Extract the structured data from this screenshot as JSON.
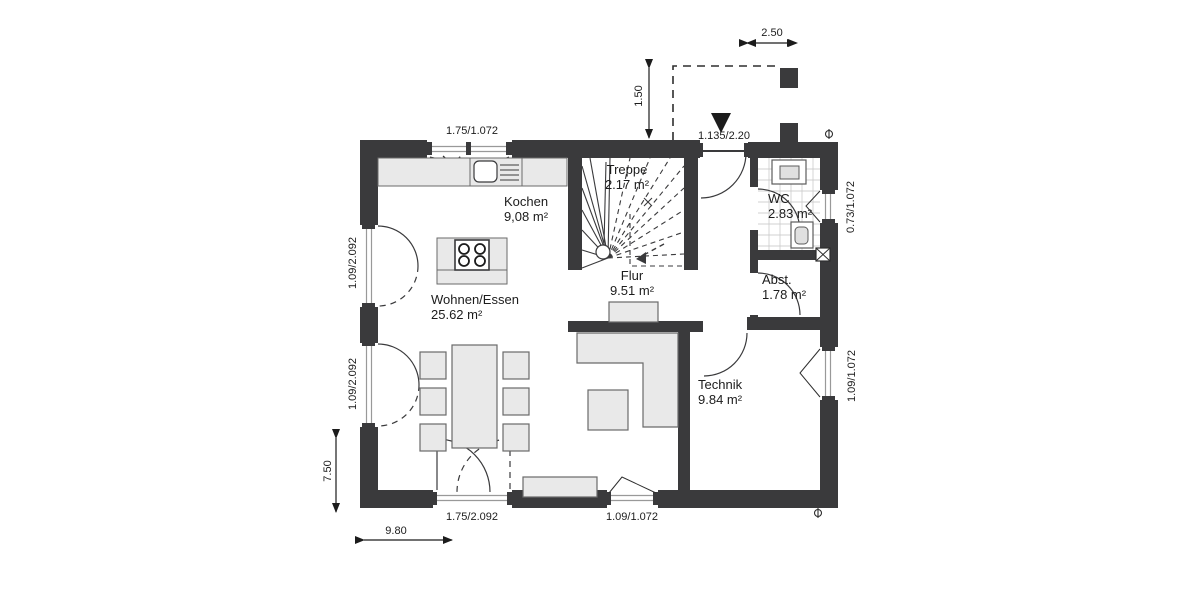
{
  "plan": {
    "type": "floor-plan",
    "rooms": {
      "treppe": {
        "name": "Treppe",
        "area": "2.17 m²"
      },
      "kochen": {
        "name": "Kochen",
        "area": "9,08 m²"
      },
      "flur": {
        "name": "Flur",
        "area": "9.51 m²"
      },
      "wc": {
        "name": "WC",
        "area": "2.83 m²"
      },
      "abst": {
        "name": "Abst.",
        "area": "1.78 m²"
      },
      "technik": {
        "name": "Technik",
        "area": "9.84 m²"
      },
      "wohnen": {
        "name": "Wohnen/Essen",
        "area": "25.62 m²"
      }
    },
    "dimensions": {
      "top_window": "1.75/1.072",
      "porch_width": "2.50",
      "porch_depth": "1.50",
      "entrance_door": "1.135/2.20",
      "wc_window": "0.73/1.072",
      "right_window": "1.09/1.072",
      "left_window_up": "1.09/2.092",
      "left_window_low": "1.09/2.092",
      "house_depth": "7.50",
      "house_width": "9.80",
      "terrace_door": "1.75/2.092",
      "bottom_window": "1.09/1.072"
    },
    "colors": {
      "wall": "#3a3a3c",
      "furniture_fill": "#e9e9e9",
      "furniture_stroke": "#5c5c5c",
      "line": "#2e2e2e",
      "glass": "#999999",
      "tile": "#c3c3c3"
    }
  }
}
